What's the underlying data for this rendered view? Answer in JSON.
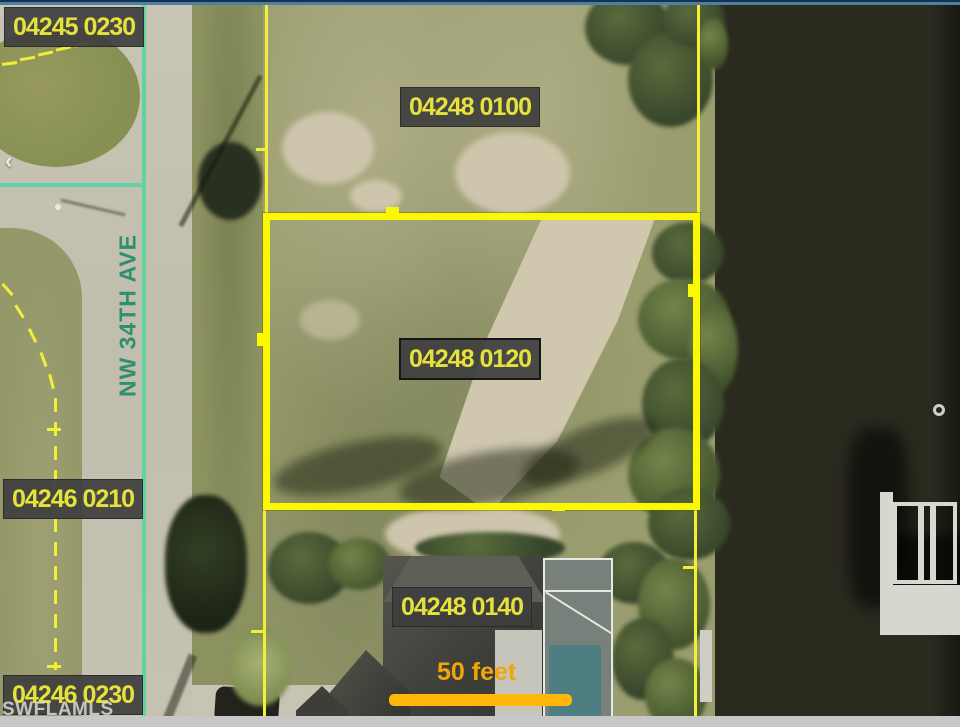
{
  "map": {
    "parcels": [
      {
        "label": "04245 0230"
      },
      {
        "label": "04248 0100"
      },
      {
        "label": "04248 0120",
        "highlighted": true
      },
      {
        "label": "04246 0210"
      },
      {
        "label": "04248 0140"
      },
      {
        "label": "04246 0230"
      }
    ],
    "street": "NW 34TH AVE",
    "scale_label": "50 feet",
    "watermark": "SWFLAMLS",
    "back_arrow_glyph": "‹",
    "colors": {
      "parcel_line_yellow": "#f3ef35",
      "highlight_yellow": "#fbf800",
      "centerline_teal": "#5fd3a5",
      "street_text_teal": "#2f8f70",
      "label_bg": "#3e3e3e",
      "label_text": "#e6e23a",
      "scale_orange": "#ffb70a",
      "water": "#2b2a1f"
    }
  }
}
